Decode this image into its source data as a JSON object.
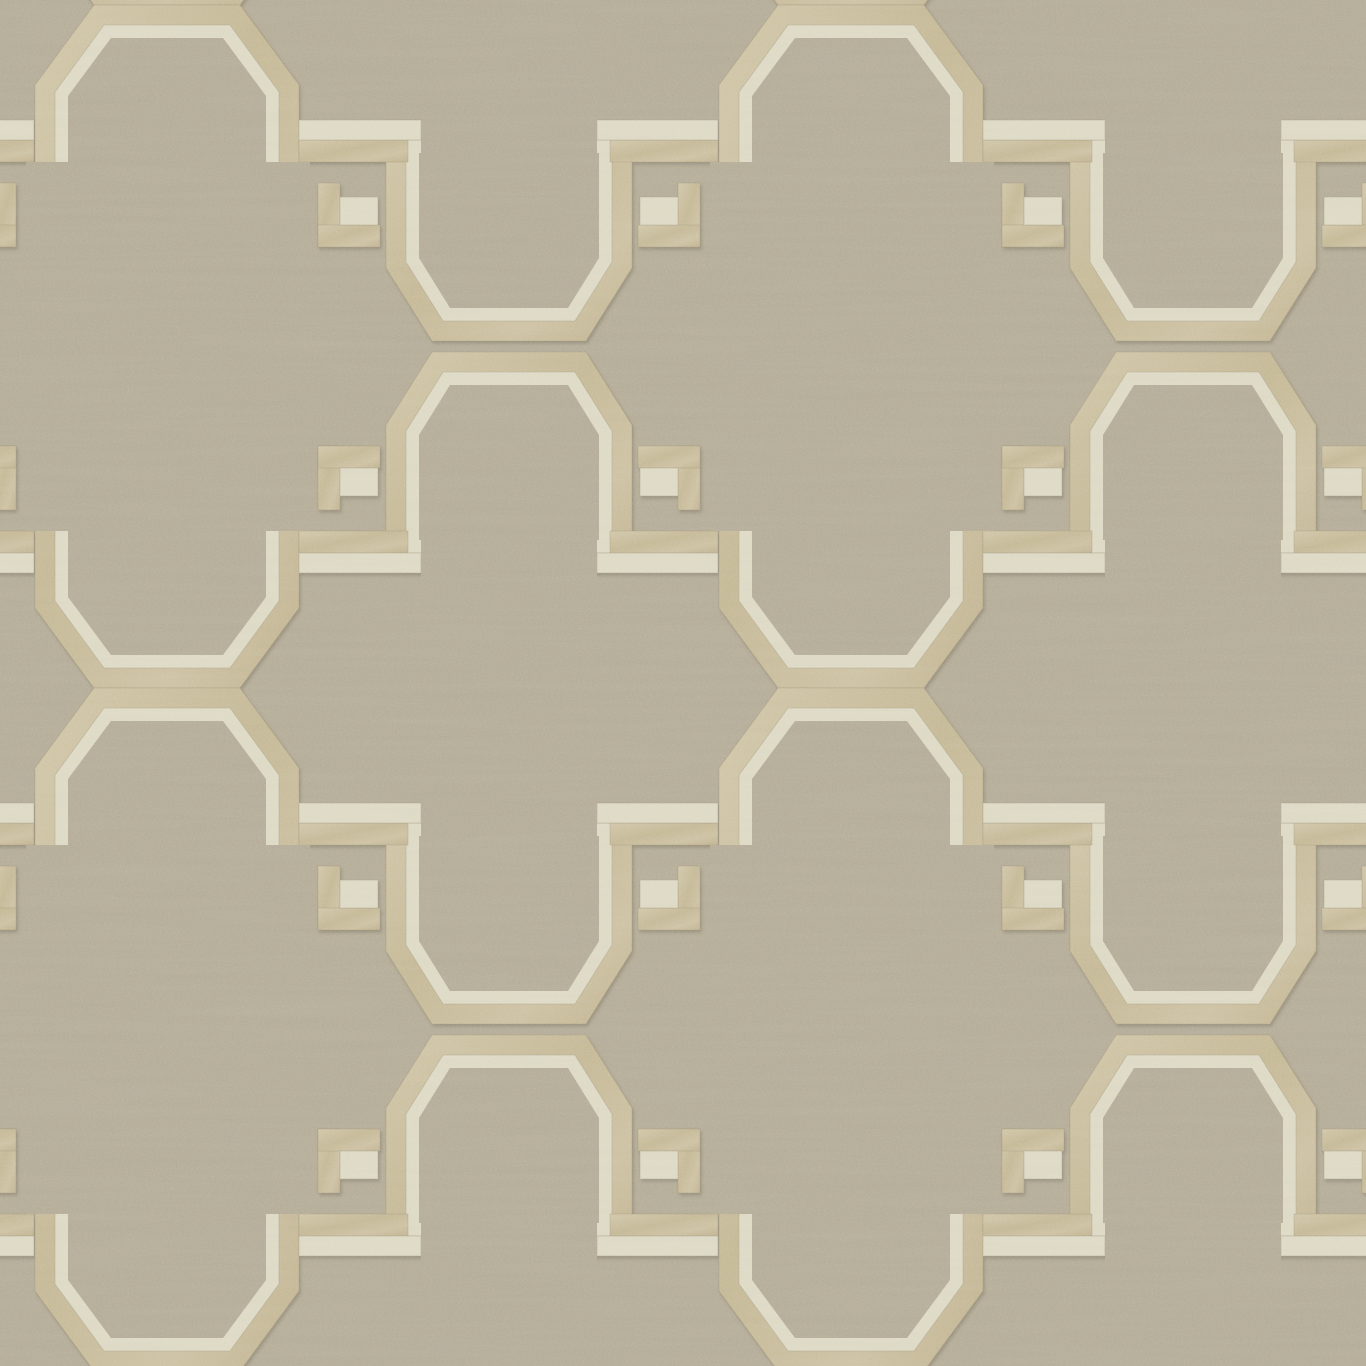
{
  "artwork": {
    "kind": "wallpaper-fabric-sample",
    "motif": "fretwork-trellis-with-greek-keys",
    "texture": "woven-linen-with-metallic-band"
  },
  "palette": {
    "linen_background": "#b3ab96",
    "linen_interior": "#b3ab96",
    "gold_band": "#c6ba9a",
    "gold_band_light": "#d0c5a7",
    "gold_band_mid": "#c3b794",
    "cream_band": "#dcd8c3",
    "band_outline": "#9a8f74",
    "cream_outline": "#a89e86",
    "shadow": "#6b6250"
  },
  "pattern": {
    "canvas_width": 1366,
    "canvas_height": 1366,
    "strip_offsets_x": [
      -684,
      0,
      684
    ],
    "unit_offsets_y": [
      -683,
      0,
      683
    ],
    "big_octagon": {
      "outer": "94,5 240,5 299,85 299,608 240,688 94,688 35,608 35,85",
      "cream": "104,25 230,25 279,92 279,601 230,668 104,668 55,601 55,92",
      "inner": "111,38 223,38 266,96 266,597 223,655 111,655 68,597 68,96"
    },
    "cup_upper": {
      "outer": "386,120 632,120 632,268 586,341 432,341 386,268",
      "cream": "406,140 612,140 612,262 575,321 443,321 406,262",
      "inner": "419,153 599,153 599,258 568,308 450,308 419,258"
    },
    "cup_lower": {
      "outer": "386,573 632,573 632,425 586,352 432,352 386,425",
      "cream": "406,553 612,553 612,431 575,372 443,372 406,431",
      "inner": "419,540 599,540 599,435 568,385 450,385 419,435"
    },
    "fret_rects": [
      [
        299,
        120,
        122,
        20,
        "cream"
      ],
      [
        299,
        140,
        109,
        22,
        "gold"
      ],
      [
        318,
        183,
        22,
        64,
        "gold"
      ],
      [
        318,
        225,
        62,
        22,
        "gold"
      ],
      [
        340,
        197,
        38,
        28,
        "cream"
      ],
      [
        597,
        120,
        121,
        20,
        "cream"
      ],
      [
        610,
        140,
        108,
        22,
        "gold"
      ],
      [
        678,
        183,
        22,
        64,
        "gold"
      ],
      [
        638,
        225,
        62,
        22,
        "gold"
      ],
      [
        640,
        197,
        38,
        28,
        "cream"
      ],
      [
        299,
        553,
        122,
        20,
        "cream"
      ],
      [
        299,
        531,
        109,
        22,
        "gold"
      ],
      [
        318,
        446,
        22,
        64,
        "gold"
      ],
      [
        318,
        446,
        62,
        22,
        "gold"
      ],
      [
        340,
        468,
        38,
        28,
        "cream"
      ],
      [
        597,
        553,
        121,
        20,
        "cream"
      ],
      [
        610,
        531,
        108,
        22,
        "gold"
      ],
      [
        678,
        446,
        22,
        64,
        "gold"
      ],
      [
        638,
        446,
        62,
        22,
        "gold"
      ],
      [
        640,
        468,
        38,
        28,
        "cream"
      ]
    ],
    "erase_rects": [
      [
        26,
        162,
        50,
        369
      ],
      [
        260,
        162,
        50,
        369
      ],
      [
        421,
        104,
        176,
        56
      ],
      [
        421,
        524,
        176,
        58
      ]
    ]
  }
}
